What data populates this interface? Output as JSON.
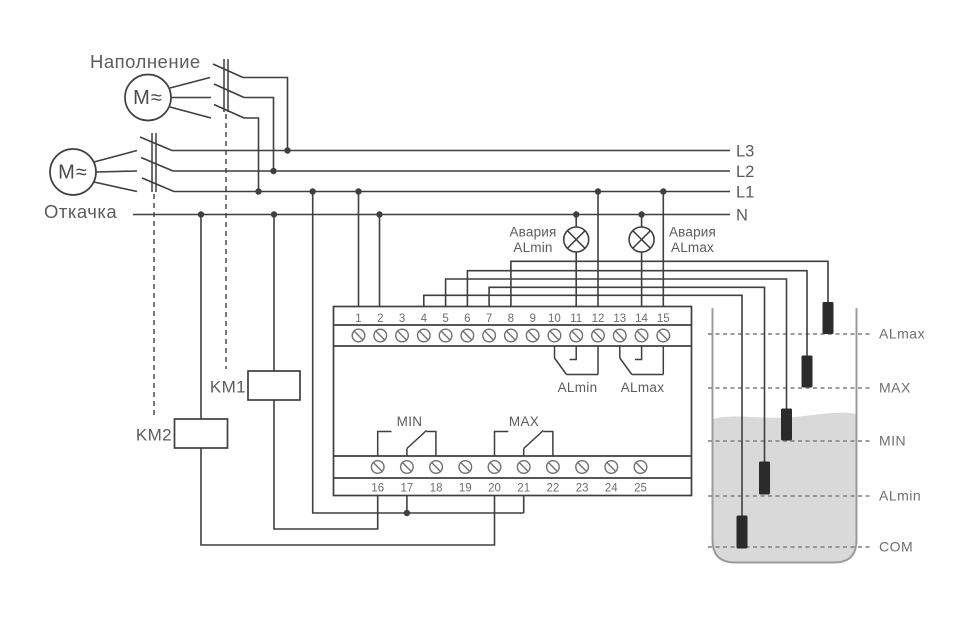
{
  "diagram": {
    "motors": {
      "fill": {
        "label": "Наполнение",
        "symbol": "M≈"
      },
      "drain": {
        "label": "Откачка",
        "symbol": "M≈"
      }
    },
    "power_lines": {
      "l3": "L3",
      "l2": "L2",
      "l1": "L1",
      "n": "N"
    },
    "alarm_lamps": {
      "min": {
        "line1": "Авария",
        "line2": "ALmin"
      },
      "max": {
        "line1": "Авария",
        "line2": "ALmax"
      }
    },
    "contactors": {
      "km1": "KM1",
      "km2": "KM2"
    },
    "device": {
      "terminals_top": [
        "1",
        "2",
        "3",
        "4",
        "5",
        "6",
        "7",
        "8",
        "9",
        "10",
        "11",
        "12",
        "13",
        "14",
        "15"
      ],
      "terminals_bottom": [
        "16",
        "17",
        "18",
        "19",
        "20",
        "21",
        "22",
        "23",
        "24",
        "25"
      ],
      "relay_labels": {
        "almin": "ALmin",
        "almax": "ALmax",
        "min": "MIN",
        "max": "MAX"
      }
    },
    "tank": {
      "levels": [
        "ALmax",
        "MAX",
        "MIN",
        "ALmin",
        "COM"
      ]
    },
    "colors": {
      "wire": "#3f3f3f",
      "text": "#5c5c5c",
      "muted_text": "#6e6e6e",
      "probe": "#2b2b2b",
      "water": "#d9d9d9",
      "tank_wall": "#9c9c9c",
      "level_dash": "#7f7f7f"
    }
  }
}
